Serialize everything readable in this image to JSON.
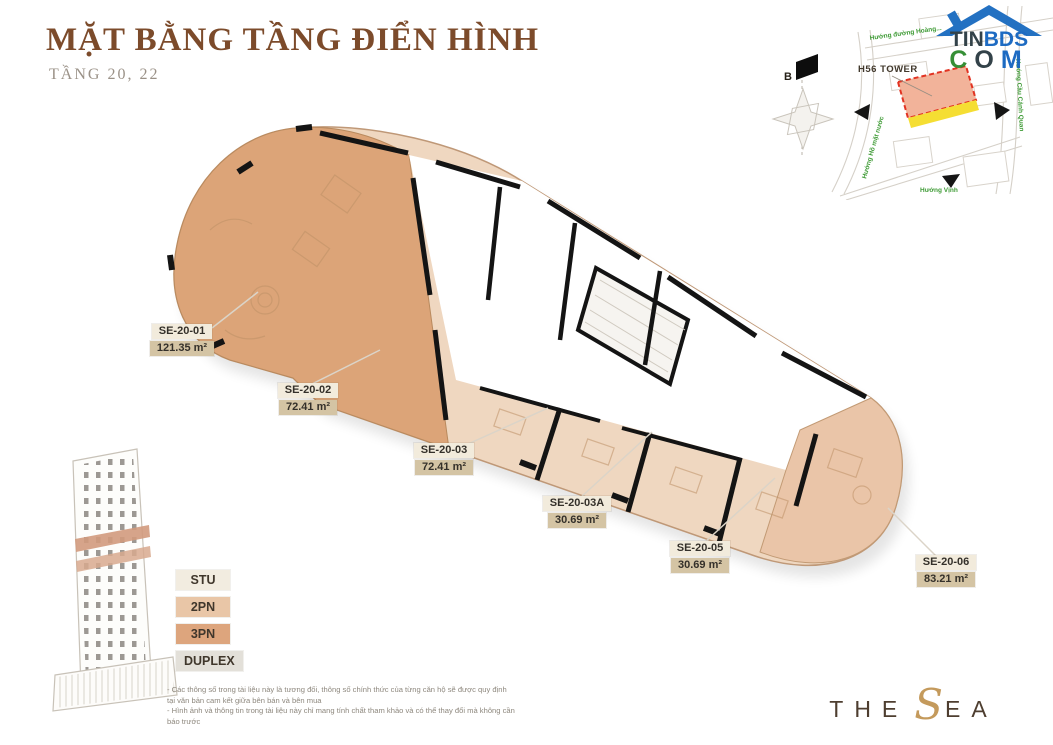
{
  "header": {
    "title": "MẶT BẰNG TẦNG ĐIỂN HÌNH",
    "subtitle": "TẦNG 20, 22"
  },
  "watermark": {
    "line1_dark": "TIN",
    "line1_blue": "BDS",
    "c": "C",
    "o": "O",
    "m": "M"
  },
  "minimap": {
    "tower_label": "H56 TOWER",
    "compass_north": "B",
    "street_top": "Hướng đường Hoàng...",
    "street_right": "Hướng Cầu Cảnh Quan",
    "street_bottom": "Hướng Vịnh",
    "street_left": "Hướng Hồ mặt nước"
  },
  "units": [
    {
      "id": "SE-20-01",
      "area": "121.35 m²"
    },
    {
      "id": "SE-20-02",
      "area": "72.41 m²"
    },
    {
      "id": "SE-20-03",
      "area": "72.41 m²"
    },
    {
      "id": "SE-20-03A",
      "area": "30.69 m²"
    },
    {
      "id": "SE-20-05",
      "area": "30.69 m²"
    },
    {
      "id": "SE-20-06",
      "area": "83.21 m²"
    }
  ],
  "legend": [
    {
      "label": "STU",
      "color": "#f2ece0"
    },
    {
      "label": "2PN",
      "color": "#e9c6a7"
    },
    {
      "label": "3PN",
      "color": "#dda57d"
    },
    {
      "label": "DUPLEX",
      "color": "#e3e0d9"
    }
  ],
  "disclaimer": {
    "line1": "- Các thông số trong tài liệu này là tương đối, thông số chính thức của từng căn hộ sẽ được quy định tại văn bản cam kết giữa bên bán và bên mua",
    "line2": "- Hình ảnh và thông tin trong tài liệu này chỉ mang tính chất tham khảo và có thể thay đổi mà không cần báo trước"
  },
  "brand": {
    "the": "THE",
    "s": "S",
    "ea": "EA"
  },
  "colors": {
    "plan_3pn": "#dca478",
    "plan_stu_strip": "#efd7c0",
    "plan_2pn_end": "#eac5a8",
    "wall": "#141414",
    "title_brown": "#7c4b2b",
    "map_highlight": "#f2b39a",
    "map_highlight_border": "#e23322",
    "map_yellow": "#f5de33",
    "street_label_green": "#3f9b36"
  }
}
